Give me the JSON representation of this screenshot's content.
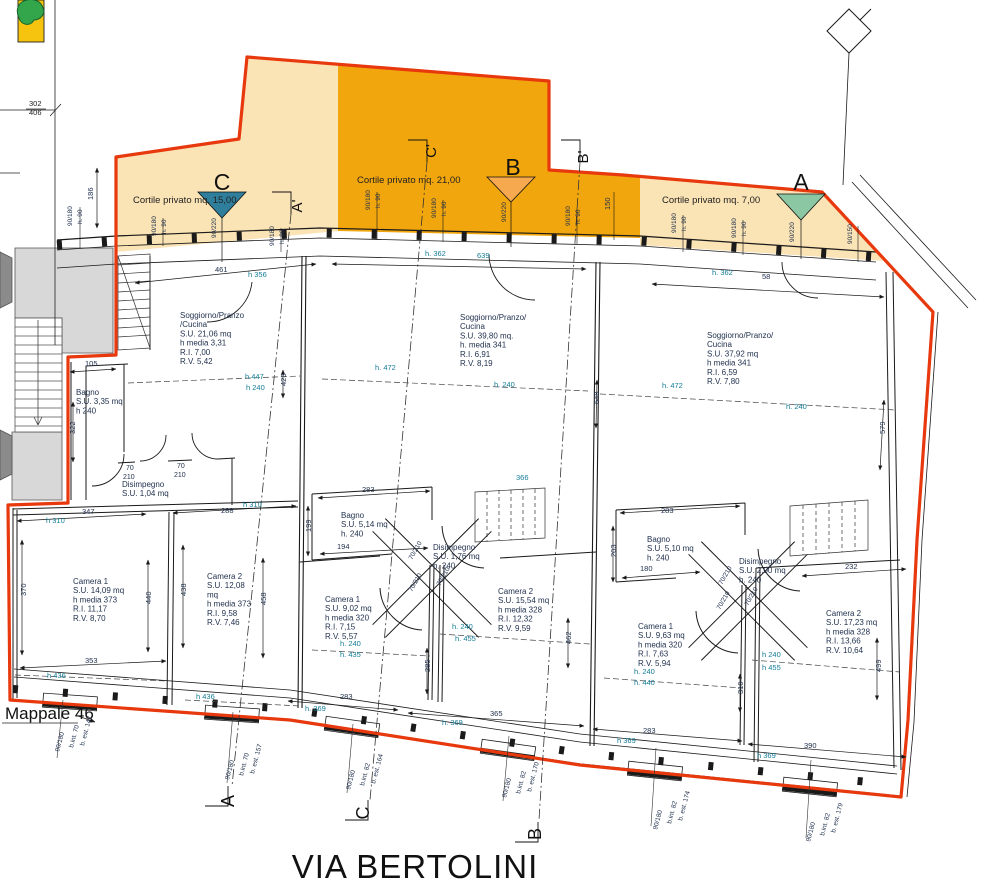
{
  "page": {
    "street_label": "VIA BERTOLINI",
    "parcel_label": "Mappale 46",
    "parcel_ref_top": "302",
    "parcel_ref_bottom": "406"
  },
  "colors": {
    "boundary_red": "#e8380d",
    "courtyard_light": "#fae3b4",
    "courtyard_dark": "#f2a60d",
    "marker_c_teal": "#2f7e9b",
    "marker_b_orange": "#f6a94f",
    "marker_a_green": "#8cc7a4",
    "tree_green": "#33a64c",
    "map_yellow": "#f6c40f",
    "dim_teal": "#147c96",
    "ink": "#22324f",
    "line": "#1a1a1a",
    "gray_fill": "#d8d8d8",
    "gray_dark": "#8b8b8b"
  },
  "courtyards": [
    {
      "id": "C",
      "label": "Cortile privato mq. 15,00",
      "x": 133,
      "y": 203
    },
    {
      "id": "B",
      "label": "Cortile privato mq. 21,00",
      "x": 357,
      "y": 183
    },
    {
      "id": "A",
      "label": "Cortile privato mq. 7,00",
      "x": 662,
      "y": 203
    }
  ],
  "section_labels": [
    {
      "t": "C",
      "x": 222,
      "y": 190,
      "fs": 23,
      "a": "middle",
      "c": "#111111"
    },
    {
      "t": "B",
      "x": 513,
      "y": 175,
      "fs": 23,
      "a": "middle",
      "c": "#111111"
    },
    {
      "t": "A",
      "x": 801,
      "y": 190,
      "fs": 23,
      "a": "middle",
      "c": "#111111"
    },
    {
      "t": "A'",
      "x": 302,
      "y": 206,
      "r": -90,
      "fs": 15,
      "a": "middle",
      "c": "#111111"
    },
    {
      "t": "C'",
      "x": 436,
      "y": 151,
      "r": -90,
      "fs": 15,
      "a": "middle",
      "c": "#111111"
    },
    {
      "t": "B'",
      "x": 588,
      "y": 157,
      "r": -90,
      "fs": 15,
      "a": "middle",
      "c": "#111111"
    },
    {
      "t": "A",
      "x": 234,
      "y": 801,
      "r": -90,
      "fs": 18,
      "a": "middle",
      "c": "#111111"
    },
    {
      "t": "C",
      "x": 369,
      "y": 813,
      "r": -90,
      "fs": 18,
      "a": "middle",
      "c": "#111111"
    },
    {
      "t": "B",
      "x": 541,
      "y": 834,
      "r": -90,
      "fs": 18,
      "a": "middle",
      "c": "#111111"
    }
  ],
  "rooms": [
    {
      "name": "soggiorno-unit-c",
      "x": 180,
      "y": 318,
      "lines": [
        "Soggiorno/Pranzo",
        "/Cucina",
        "S.U. 21,06 mq",
        "h media 3,31",
        "R.I. 7,00",
        "R.V. 5,42"
      ]
    },
    {
      "name": "soggiorno-unit-b",
      "x": 460,
      "y": 320,
      "lines": [
        "Soggiorno/Pranzo/",
        "Cucina",
        "S.U. 39,80 mq.",
        "h. media 341",
        "R.I. 6,91",
        "R.V. 8,19"
      ]
    },
    {
      "name": "soggiorno-unit-a",
      "x": 707,
      "y": 338,
      "lines": [
        "Soggiorno/Pranzo/",
        "Cucina",
        "S.U. 37,92 mq",
        "h media 341",
        "R.I. 6,59",
        "R.V. 7,80"
      ]
    },
    {
      "name": "bagno-unit-c",
      "x": 76,
      "y": 395,
      "lines": [
        "Bagno",
        "S.U. 3,35 mq",
        "h 240"
      ]
    },
    {
      "name": "disimpegno-unit-c",
      "x": 122,
      "y": 487,
      "lines": [
        "Disimpegno",
        "S.U. 1,04 mq"
      ]
    },
    {
      "name": "camera1-unit-c",
      "x": 73,
      "y": 584,
      "lines": [
        "Camera 1",
        "S.U. 14,09 mq",
        "h media 373",
        "R.I. 11,17",
        "R.V. 8,70"
      ]
    },
    {
      "name": "camera2-unit-c",
      "x": 207,
      "y": 579,
      "lines": [
        "Camera 2",
        "S.U. 12,08",
        "mq",
        "h media 373",
        "R.I. 9,58",
        "R.V. 7,46"
      ]
    },
    {
      "name": "bagno-unit-b",
      "x": 341,
      "y": 518,
      "lines": [
        "Bagno",
        "S.U. 5,14 mq",
        "h. 240"
      ]
    },
    {
      "name": "disimpegno-unit-b",
      "x": 433,
      "y": 550,
      "lines": [
        "Disimpegno",
        "S.U. 1,76 mq",
        "h. 240"
      ]
    },
    {
      "name": "camera1-unit-b",
      "x": 325,
      "y": 602,
      "lines": [
        "Camera 1",
        "S.U. 9,02 mq",
        "h media 320",
        "R.I. 7,15",
        "R.V. 5,57"
      ]
    },
    {
      "name": "camera2-unit-b",
      "x": 498,
      "y": 594,
      "lines": [
        "Camera 2",
        "S.U. 15,54 mq",
        "h media 328",
        "R.I. 12,32",
        "R.V. 9,59"
      ]
    },
    {
      "name": "bagno-unit-a",
      "x": 647,
      "y": 542,
      "lines": [
        "Bagno",
        "S.U. 5,10 mq",
        "h. 240"
      ]
    },
    {
      "name": "disimpegno-unit-a",
      "x": 739,
      "y": 564,
      "lines": [
        "Disimpegno",
        "S.U. 2,00 mq",
        "h. 240"
      ]
    },
    {
      "name": "camera1-unit-a",
      "x": 638,
      "y": 629,
      "lines": [
        "Camera 1",
        "S.U. 9,63 mq",
        "h media 320",
        "R.I. 7,63",
        "R.V. 5,94"
      ]
    },
    {
      "name": "camera2-unit-a",
      "x": 826,
      "y": 616,
      "lines": [
        "Camera 2",
        "S.U. 17,23 mq",
        "h media 328",
        "R.I. 13,66",
        "R.V. 10,64"
      ]
    }
  ],
  "annotations": [
    {
      "t": "186",
      "x": 93,
      "y": 200,
      "r": -90
    },
    {
      "t": "90/180",
      "x": 72,
      "y": 226,
      "r": -90,
      "fs": 6.5
    },
    {
      "t": "h. 90",
      "x": 82,
      "y": 224,
      "r": -90,
      "fs": 6.5
    },
    {
      "t": "90/180",
      "x": 156,
      "y": 236,
      "r": -90,
      "fs": 6.5
    },
    {
      "t": "h. 90",
      "x": 166,
      "y": 234,
      "r": -90,
      "fs": 6.5
    },
    {
      "t": "90/220",
      "x": 216,
      "y": 238,
      "r": -90,
      "fs": 6.5
    },
    {
      "t": "90/180",
      "x": 274,
      "y": 246,
      "r": -90,
      "fs": 6.5
    },
    {
      "t": "h. 90",
      "x": 284,
      "y": 244,
      "r": -90,
      "fs": 6.5
    },
    {
      "t": "90/180",
      "x": 370,
      "y": 210,
      "r": -90,
      "fs": 6.5
    },
    {
      "t": "h. 90",
      "x": 380,
      "y": 208,
      "r": -90,
      "fs": 6.5
    },
    {
      "t": "90/180",
      "x": 436,
      "y": 218,
      "r": -90,
      "fs": 6.5
    },
    {
      "t": "h. 90",
      "x": 446,
      "y": 216,
      "r": -90,
      "fs": 6.5
    },
    {
      "t": "90/220",
      "x": 506,
      "y": 222,
      "r": -90,
      "fs": 6.5
    },
    {
      "t": "90/180",
      "x": 570,
      "y": 226,
      "r": -90,
      "fs": 6.5
    },
    {
      "t": "h. 90",
      "x": 580,
      "y": 224,
      "r": -90,
      "fs": 6.5
    },
    {
      "t": "150",
      "x": 610,
      "y": 210,
      "r": -90
    },
    {
      "t": "90/180",
      "x": 676,
      "y": 233,
      "r": -90,
      "fs": 6.5
    },
    {
      "t": "h. 90",
      "x": 686,
      "y": 231,
      "r": -90,
      "fs": 6.5
    },
    {
      "t": "90/180",
      "x": 736,
      "y": 238,
      "r": -90,
      "fs": 6.5
    },
    {
      "t": "h. 90",
      "x": 746,
      "y": 236,
      "r": -90,
      "fs": 6.5
    },
    {
      "t": "90/220",
      "x": 794,
      "y": 242,
      "r": -90,
      "fs": 6.5
    },
    {
      "t": "90/150",
      "x": 852,
      "y": 244,
      "r": -90,
      "fs": 6.5
    },
    {
      "t": "461",
      "x": 215,
      "y": 272
    },
    {
      "t": "h 356",
      "x": 248,
      "y": 277,
      "c": "t"
    },
    {
      "t": "h. 362",
      "x": 425,
      "y": 256,
      "c": "t"
    },
    {
      "t": "639",
      "x": 477,
      "y": 258,
      "c": "t"
    },
    {
      "t": "h. 362",
      "x": 712,
      "y": 275,
      "c": "t"
    },
    {
      "t": "58",
      "x": 762,
      "y": 279
    },
    {
      "t": "h 447",
      "x": 245,
      "y": 379,
      "c": "t"
    },
    {
      "t": "h 240",
      "x": 246,
      "y": 390,
      "c": "t"
    },
    {
      "t": "423",
      "x": 286,
      "y": 386,
      "r": -90
    },
    {
      "t": "h. 472",
      "x": 375,
      "y": 370,
      "c": "t"
    },
    {
      "t": "h. 240",
      "x": 494,
      "y": 387,
      "c": "t"
    },
    {
      "t": "366",
      "x": 516,
      "y": 480,
      "c": "t"
    },
    {
      "t": "648",
      "x": 599,
      "y": 404,
      "r": -90
    },
    {
      "t": "h. 472",
      "x": 662,
      "y": 388,
      "c": "t"
    },
    {
      "t": "h. 240",
      "x": 786,
      "y": 409,
      "c": "t"
    },
    {
      "t": "579",
      "x": 885,
      "y": 434,
      "r": -90
    },
    {
      "t": "105",
      "x": 85,
      "y": 366
    },
    {
      "t": "322",
      "x": 75,
      "y": 434,
      "r": -90
    },
    {
      "t": "70",
      "x": 126,
      "y": 470,
      "fs": 7
    },
    {
      "t": "210",
      "x": 123,
      "y": 479,
      "fs": 7
    },
    {
      "t": "70",
      "x": 177,
      "y": 468,
      "fs": 7
    },
    {
      "t": "210",
      "x": 174,
      "y": 477,
      "fs": 7
    },
    {
      "t": "347",
      "x": 82,
      "y": 514
    },
    {
      "t": "h 310",
      "x": 46,
      "y": 523,
      "c": "t"
    },
    {
      "t": "288",
      "x": 221,
      "y": 513
    },
    {
      "t": "h 310",
      "x": 243,
      "y": 507,
      "c": "t"
    },
    {
      "t": "370",
      "x": 26,
      "y": 596,
      "r": -90
    },
    {
      "t": "440",
      "x": 151,
      "y": 604,
      "r": -90
    },
    {
      "t": "438",
      "x": 186,
      "y": 596,
      "r": -90
    },
    {
      "t": "458",
      "x": 266,
      "y": 605,
      "r": -90
    },
    {
      "t": "353",
      "x": 85,
      "y": 663
    },
    {
      "t": "h 436",
      "x": 47,
      "y": 678,
      "c": "t"
    },
    {
      "t": "h 436",
      "x": 196,
      "y": 699,
      "c": "t"
    },
    {
      "t": "199",
      "x": 311,
      "y": 532,
      "r": -90
    },
    {
      "t": "283",
      "x": 362,
      "y": 492
    },
    {
      "t": "194",
      "x": 337,
      "y": 549
    },
    {
      "t": "70/210",
      "x": 412,
      "y": 560,
      "r": -60,
      "fs": 6.5
    },
    {
      "t": "70/210",
      "x": 412,
      "y": 592,
      "r": -60,
      "fs": 6.5
    },
    {
      "t": "70/210",
      "x": 440,
      "y": 586,
      "r": -60,
      "fs": 6.5
    },
    {
      "t": "h. 240",
      "x": 340,
      "y": 646,
      "c": "t"
    },
    {
      "t": "h. 435",
      "x": 340,
      "y": 657,
      "c": "t"
    },
    {
      "t": "285",
      "x": 430,
      "y": 672,
      "r": -90
    },
    {
      "t": "h. 240",
      "x": 452,
      "y": 629,
      "c": "t"
    },
    {
      "t": "h. 455",
      "x": 455,
      "y": 641,
      "c": "t"
    },
    {
      "t": "462",
      "x": 571,
      "y": 644,
      "r": -90
    },
    {
      "t": "283",
      "x": 661,
      "y": 513
    },
    {
      "t": "203",
      "x": 616,
      "y": 557,
      "r": -90
    },
    {
      "t": "180",
      "x": 640,
      "y": 571
    },
    {
      "t": "70/210",
      "x": 722,
      "y": 585,
      "r": -60,
      "fs": 6.5
    },
    {
      "t": "70/210",
      "x": 720,
      "y": 610,
      "r": -60,
      "fs": 6.5
    },
    {
      "t": "70/210",
      "x": 748,
      "y": 606,
      "r": -60,
      "fs": 6.5
    },
    {
      "t": "h. 240",
      "x": 634,
      "y": 674,
      "c": "t"
    },
    {
      "t": "h. 440",
      "x": 634,
      "y": 685,
      "c": "t"
    },
    {
      "t": "h 240",
      "x": 762,
      "y": 657,
      "c": "t"
    },
    {
      "t": "h 455",
      "x": 762,
      "y": 670,
      "c": "t"
    },
    {
      "t": "232",
      "x": 845,
      "y": 569
    },
    {
      "t": "499",
      "x": 881,
      "y": 672,
      "r": -90
    },
    {
      "t": "310",
      "x": 743,
      "y": 694,
      "r": -90
    },
    {
      "t": "283",
      "x": 340,
      "y": 699
    },
    {
      "t": "h. 369",
      "x": 305,
      "y": 711,
      "c": "t"
    },
    {
      "t": "365",
      "x": 490,
      "y": 716
    },
    {
      "t": "h. 369",
      "x": 442,
      "y": 725,
      "c": "t"
    },
    {
      "t": "283",
      "x": 643,
      "y": 733
    },
    {
      "t": "h 369",
      "x": 617,
      "y": 743,
      "c": "t"
    },
    {
      "t": "390",
      "x": 804,
      "y": 748
    },
    {
      "t": "h 369",
      "x": 757,
      "y": 758,
      "c": "t"
    },
    {
      "t": "90/180",
      "x": 59,
      "y": 752,
      "r": -75,
      "fs": 6.5
    },
    {
      "t": "b.int. 70",
      "x": 73,
      "y": 748,
      "r": -75,
      "fs": 6.5
    },
    {
      "t": "b. est. 147",
      "x": 84,
      "y": 746,
      "r": -75,
      "fs": 6.5
    },
    {
      "t": "90/180",
      "x": 229,
      "y": 780,
      "r": -75,
      "fs": 6.5
    },
    {
      "t": "b.int. 70",
      "x": 243,
      "y": 776,
      "r": -75,
      "fs": 6.5
    },
    {
      "t": "b. est. 157",
      "x": 254,
      "y": 774,
      "r": -75,
      "fs": 6.5
    },
    {
      "t": "90/180",
      "x": 350,
      "y": 790,
      "r": -75,
      "fs": 6.5
    },
    {
      "t": "b.int. 82",
      "x": 364,
      "y": 786,
      "r": -75,
      "fs": 6.5
    },
    {
      "t": "b. est. 164",
      "x": 375,
      "y": 784,
      "r": -75,
      "fs": 6.5
    },
    {
      "t": "90/180",
      "x": 506,
      "y": 798,
      "r": -75,
      "fs": 6.5
    },
    {
      "t": "b.int. 82",
      "x": 520,
      "y": 794,
      "r": -75,
      "fs": 6.5
    },
    {
      "t": "b. est. 170",
      "x": 531,
      "y": 792,
      "r": -75,
      "fs": 6.5
    },
    {
      "t": "90/180",
      "x": 657,
      "y": 830,
      "r": -75,
      "fs": 6.5
    },
    {
      "t": "b.int. 82",
      "x": 671,
      "y": 824,
      "r": -75,
      "fs": 6.5
    },
    {
      "t": "b. est. 174",
      "x": 682,
      "y": 821,
      "r": -75,
      "fs": 6.5
    },
    {
      "t": "90/180",
      "x": 810,
      "y": 842,
      "r": -75,
      "fs": 6.5
    },
    {
      "t": "b.int. 82",
      "x": 824,
      "y": 836,
      "r": -75,
      "fs": 6.5
    },
    {
      "t": "b. est. 179",
      "x": 835,
      "y": 833,
      "r": -75,
      "fs": 6.5
    }
  ]
}
